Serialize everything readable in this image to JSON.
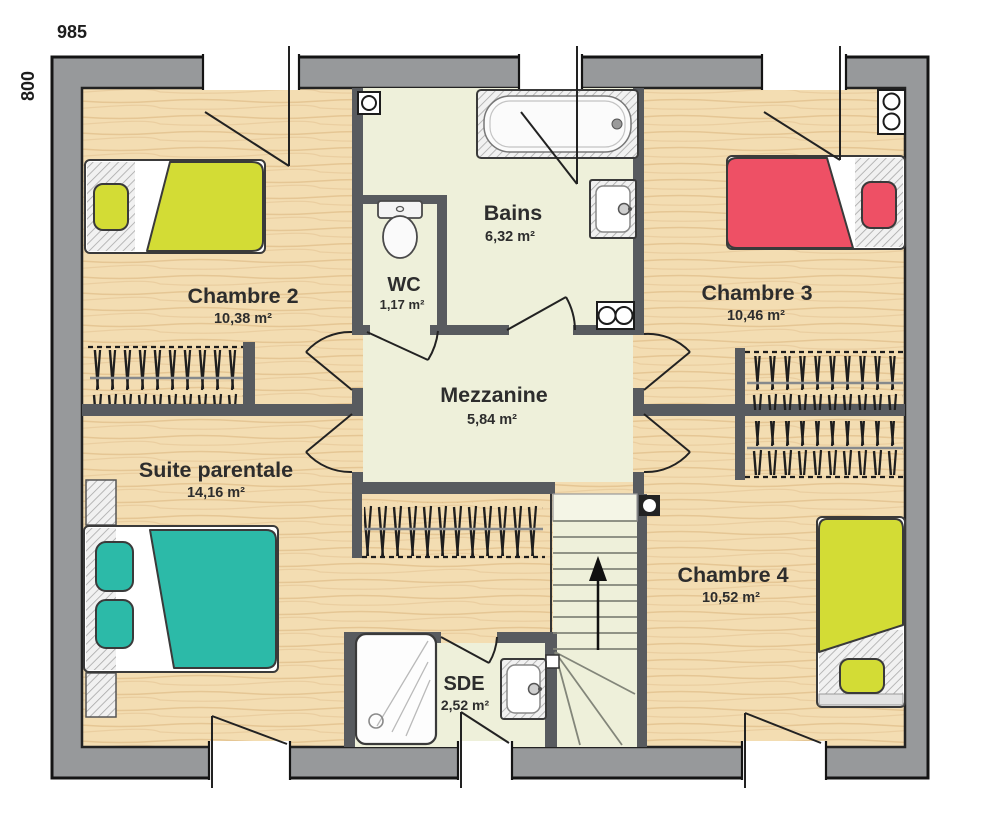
{
  "plan": {
    "dimensions": {
      "width_label": "985",
      "height_label": "800"
    },
    "rooms": {
      "chambre2": {
        "name": "Chambre 2",
        "area": "10,38 m²"
      },
      "wc": {
        "name": "WC",
        "area": "1,17 m²"
      },
      "bains": {
        "name": "Bains",
        "area": "6,32 m²"
      },
      "chambre3": {
        "name": "Chambre 3",
        "area": "10,46 m²"
      },
      "mezzanine": {
        "name": "Mezzanine",
        "area": "5,84 m²"
      },
      "suite": {
        "name": "Suite parentale",
        "area": "14,16 m²"
      },
      "chambre4": {
        "name": "Chambre 4",
        "area": "10,52 m²"
      },
      "sde": {
        "name": "SDE",
        "area": "2,52 m²"
      }
    },
    "colors": {
      "exterior_wall": "#97999b",
      "interior_wall": "#585b5f",
      "wood_floor": "#f3ddb2",
      "wet_floor": "#eef0da",
      "bed_yellow": "#d3dc35",
      "bed_red": "#ee5065",
      "bed_teal": "#2cbaa8"
    }
  }
}
